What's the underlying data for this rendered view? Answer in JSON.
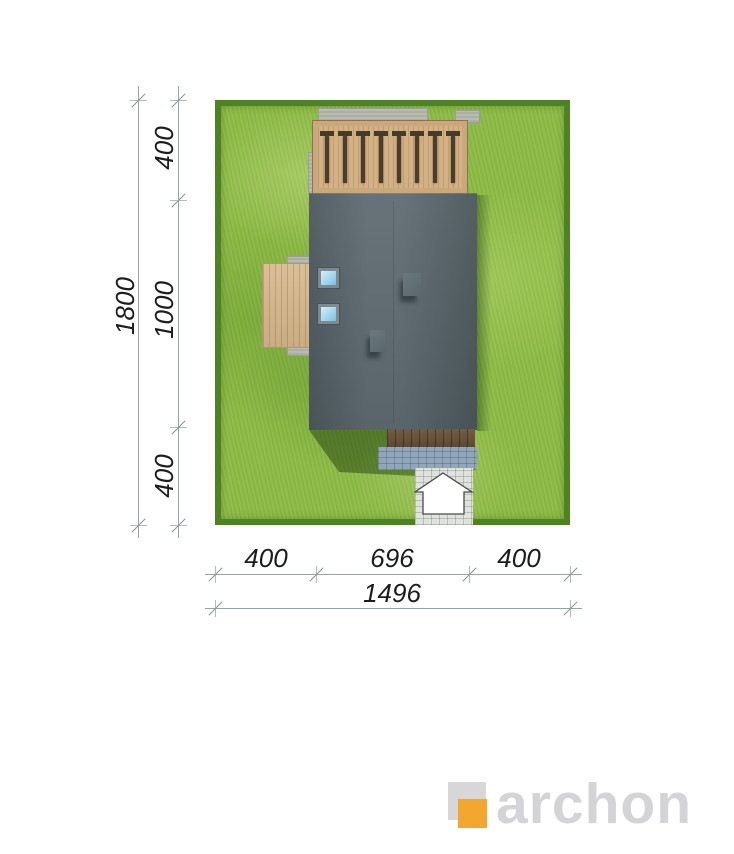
{
  "drawing": {
    "type": "house-site-plan-top-view",
    "dims": {
      "left": {
        "segments": [
          "400",
          "1000",
          "400"
        ],
        "total": "1800"
      },
      "bottom": {
        "segments": [
          "400",
          "696",
          "400"
        ],
        "total": "1496"
      }
    }
  },
  "icons": {
    "entrance_arrow": "entrance-arrow",
    "logo_mark": "archon-square-mark"
  },
  "logo": {
    "text": "archon"
  },
  "colors": {
    "grass": "#8dbb45",
    "hedge": "#4f8222",
    "roof": "#57646a",
    "wood_light": "#d7b78b",
    "wood_dark": "#6b5339",
    "skylight_blue": "#79c0e2",
    "cobble_blue": "#91a7b9",
    "cobble_light": "#e0e2dd",
    "logo_gray": "#d4d4d6",
    "logo_orange": "#f4a72e",
    "dim_line": "#9aa3a3",
    "dim_text": "#1d1d1d"
  }
}
